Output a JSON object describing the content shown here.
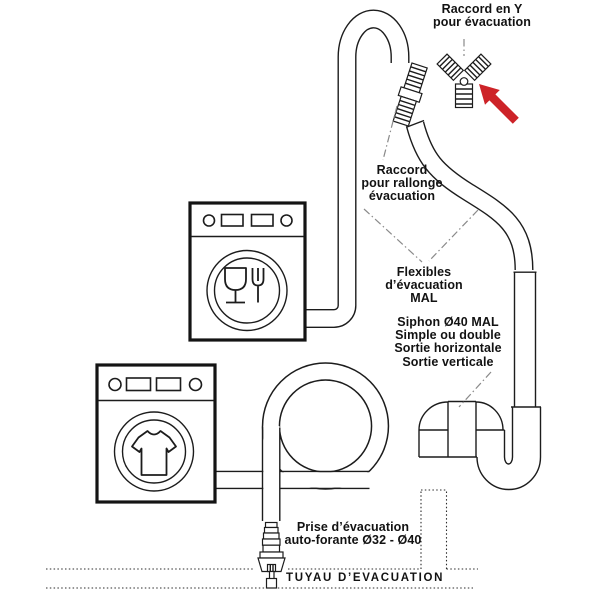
{
  "labels": {
    "raccord_y": [
      "Raccord en Y",
      "pour évacuation"
    ],
    "raccord_rallonge": [
      "Raccord",
      "pour rallonge",
      "évacuation"
    ],
    "flexibles": [
      "Flexibles",
      "d’évacuation",
      "MAL"
    ],
    "siphon": [
      "Siphon Ø40 MAL",
      "Simple ou double",
      "Sortie horizontale",
      "Sortie verticale"
    ],
    "prise": [
      "Prise d’évacuation",
      "auto-forante Ø32 - Ø40"
    ],
    "tuyau": "TUYAU D’EVACUATION"
  },
  "colors": {
    "arrow_red": "#cd2328",
    "line": "#1c1c1c",
    "leader_gray": "#8a8a8a"
  },
  "icons": {
    "y_connector": "y-connector-icon",
    "red_arrow": "red-arrow-icon",
    "dishwasher": "dishwasher-icon",
    "washing_machine": "washing-machine-icon",
    "siphon": "siphon-trap-icon",
    "drain_tap": "self-drilling-tap-icon"
  }
}
